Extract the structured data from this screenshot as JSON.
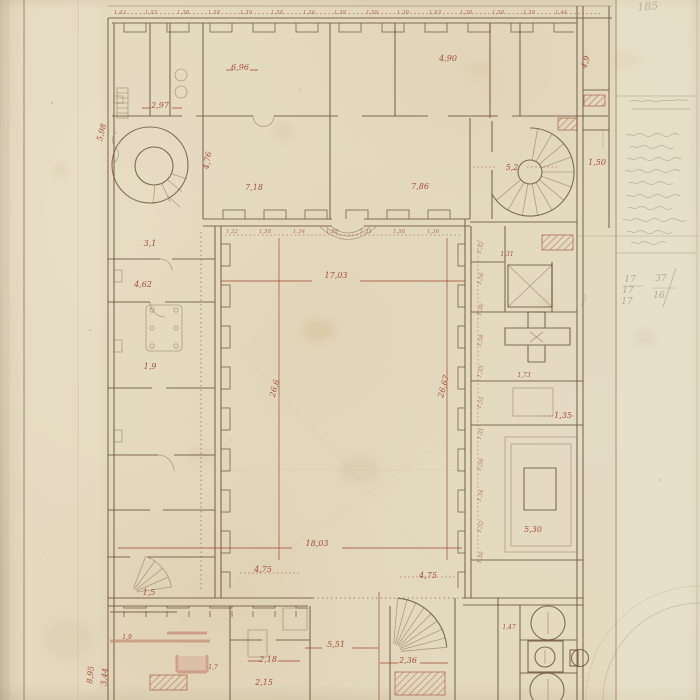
{
  "artwork": {
    "title": "Hand-drawn architectural ground plan, pen and red ink on aged paper",
    "subject": "Rectangular building with central courtyard, round corner tower and spiral staircases",
    "corner_inscription": "185"
  },
  "palette": {
    "paper": "#e4d9bf",
    "ink": "#6a5138",
    "red_ink": "#9c3b26",
    "pink_wall": "#c5836e",
    "pencil": "#8d8168"
  },
  "plan": {
    "courtyard_width_label": "17,03",
    "courtyard_south_label": "18,03",
    "courtyard_depth_left_label": "26,6",
    "courtyard_depth_right_label": "26,67",
    "labels": [
      {
        "t": "2,97",
        "x": 160,
        "y": 108
      },
      {
        "t": "6,96",
        "x": 240,
        "y": 70
      },
      {
        "t": "4,90",
        "x": 448,
        "y": 61
      },
      {
        "t": "5,98",
        "x": 104,
        "y": 133,
        "r": -75
      },
      {
        "t": "7,18",
        "x": 254,
        "y": 190
      },
      {
        "t": "7,86",
        "x": 420,
        "y": 189
      },
      {
        "t": "4,76",
        "x": 210,
        "y": 161,
        "r": -80
      },
      {
        "t": "5,2",
        "x": 512,
        "y": 170
      },
      {
        "t": "1,50",
        "x": 597,
        "y": 165
      },
      {
        "t": "4,9",
        "x": 588,
        "y": 63,
        "r": -70
      },
      {
        "t": "17,03",
        "x": 336,
        "y": 278
      },
      {
        "t": "26,6",
        "x": 277,
        "y": 389,
        "r": -75
      },
      {
        "t": "26,67",
        "x": 446,
        "y": 387,
        "r": -75
      },
      {
        "t": "18,03",
        "x": 317,
        "y": 546
      },
      {
        "t": "4,75",
        "x": 263,
        "y": 572
      },
      {
        "t": "4,75",
        "x": 428,
        "y": 578
      },
      {
        "t": "5,51",
        "x": 336,
        "y": 647
      },
      {
        "t": "2,36",
        "x": 408,
        "y": 663
      },
      {
        "t": "2,18",
        "x": 268,
        "y": 662
      },
      {
        "t": "2,15",
        "x": 264,
        "y": 685
      },
      {
        "t": "1,35",
        "x": 563,
        "y": 418
      },
      {
        "t": "5,30",
        "x": 533,
        "y": 532
      },
      {
        "t": "8,95",
        "x": 93,
        "y": 675,
        "r": -85
      },
      {
        "t": "3,44",
        "x": 107,
        "y": 677,
        "r": -85
      },
      {
        "t": "4,62",
        "x": 143,
        "y": 287
      },
      {
        "t": "1,9",
        "x": 150,
        "y": 369
      },
      {
        "t": "1,5",
        "x": 149,
        "y": 595
      },
      {
        "t": "3,1",
        "x": 150,
        "y": 246
      },
      {
        "t": "1,9",
        "x": 127,
        "y": 639,
        "s": 6
      },
      {
        "t": "1,7",
        "x": 213,
        "y": 669,
        "s": 6
      },
      {
        "t": "1,73",
        "x": 524,
        "y": 377,
        "s": 6
      },
      {
        "t": "1,47",
        "x": 509,
        "y": 629,
        "s": 6
      },
      {
        "t": "1,31",
        "x": 507,
        "y": 256,
        "s": 6
      },
      {
        "t": "1,43",
        "x": 120,
        "y": 14,
        "c": "tiny"
      },
      {
        "t": "1,93",
        "x": 151,
        "y": 14,
        "c": "tiny"
      },
      {
        "t": "1,38",
        "x": 183,
        "y": 14,
        "c": "tiny"
      },
      {
        "t": "1,58",
        "x": 214,
        "y": 14,
        "c": "tiny"
      },
      {
        "t": "1,39",
        "x": 246,
        "y": 14,
        "c": "tiny"
      },
      {
        "t": "1,58",
        "x": 277,
        "y": 14,
        "c": "tiny"
      },
      {
        "t": "1,36",
        "x": 309,
        "y": 14,
        "c": "tiny"
      },
      {
        "t": "1,38",
        "x": 340,
        "y": 14,
        "c": "tiny"
      },
      {
        "t": "1,58",
        "x": 372,
        "y": 14,
        "c": "tiny"
      },
      {
        "t": "1,36",
        "x": 403,
        "y": 14,
        "c": "tiny"
      },
      {
        "t": "1,93",
        "x": 435,
        "y": 14,
        "c": "tiny"
      },
      {
        "t": "1,38",
        "x": 466,
        "y": 14,
        "c": "tiny"
      },
      {
        "t": "1,58",
        "x": 498,
        "y": 14,
        "c": "tiny"
      },
      {
        "t": "1,39",
        "x": 529,
        "y": 14,
        "c": "tiny"
      },
      {
        "t": "1,44",
        "x": 561,
        "y": 14,
        "c": "tiny"
      },
      {
        "t": "1,32",
        "x": 232,
        "y": 233,
        "c": "tiny"
      },
      {
        "t": "1,58",
        "x": 265,
        "y": 233,
        "c": "tiny"
      },
      {
        "t": "1,34",
        "x": 299,
        "y": 233,
        "c": "tiny"
      },
      {
        "t": "1,58",
        "x": 332,
        "y": 233,
        "c": "tiny"
      },
      {
        "t": "1,31",
        "x": 366,
        "y": 233,
        "c": "tiny"
      },
      {
        "t": "1,58",
        "x": 399,
        "y": 233,
        "c": "tiny"
      },
      {
        "t": "1,36",
        "x": 433,
        "y": 233,
        "c": "tiny"
      },
      {
        "t": "1,32",
        "x": 482,
        "y": 248,
        "c": "tiny",
        "r": -75
      },
      {
        "t": "1,56",
        "x": 482,
        "y": 279,
        "c": "tiny",
        "r": -75
      },
      {
        "t": "1,30",
        "x": 482,
        "y": 310,
        "c": "tiny",
        "r": -75
      },
      {
        "t": "1,58",
        "x": 482,
        "y": 341,
        "c": "tiny",
        "r": -75
      },
      {
        "t": "1,33",
        "x": 482,
        "y": 372,
        "c": "tiny",
        "r": -75
      },
      {
        "t": "1,55",
        "x": 482,
        "y": 403,
        "c": "tiny",
        "r": -75
      },
      {
        "t": "1,31",
        "x": 482,
        "y": 434,
        "c": "tiny",
        "r": -75
      },
      {
        "t": "1,58",
        "x": 482,
        "y": 465,
        "c": "tiny",
        "r": -75
      },
      {
        "t": "1,34",
        "x": 482,
        "y": 496,
        "c": "tiny",
        "r": -75
      },
      {
        "t": "1,52",
        "x": 482,
        "y": 527,
        "c": "tiny",
        "r": -75
      },
      {
        "t": "1,30",
        "x": 482,
        "y": 558,
        "c": "tiny",
        "r": -75
      }
    ]
  },
  "margin": {
    "notes": {
      "legible": false,
      "line_count": 9,
      "boxed": true
    },
    "figures": [
      {
        "t": "17",
        "x": 630,
        "y": 282
      },
      {
        "t": "17",
        "x": 628,
        "y": 293
      },
      {
        "t": "17",
        "x": 627,
        "y": 304
      },
      {
        "t": "37",
        "x": 661,
        "y": 281
      },
      {
        "t": "16",
        "x": 659,
        "y": 298
      }
    ]
  }
}
